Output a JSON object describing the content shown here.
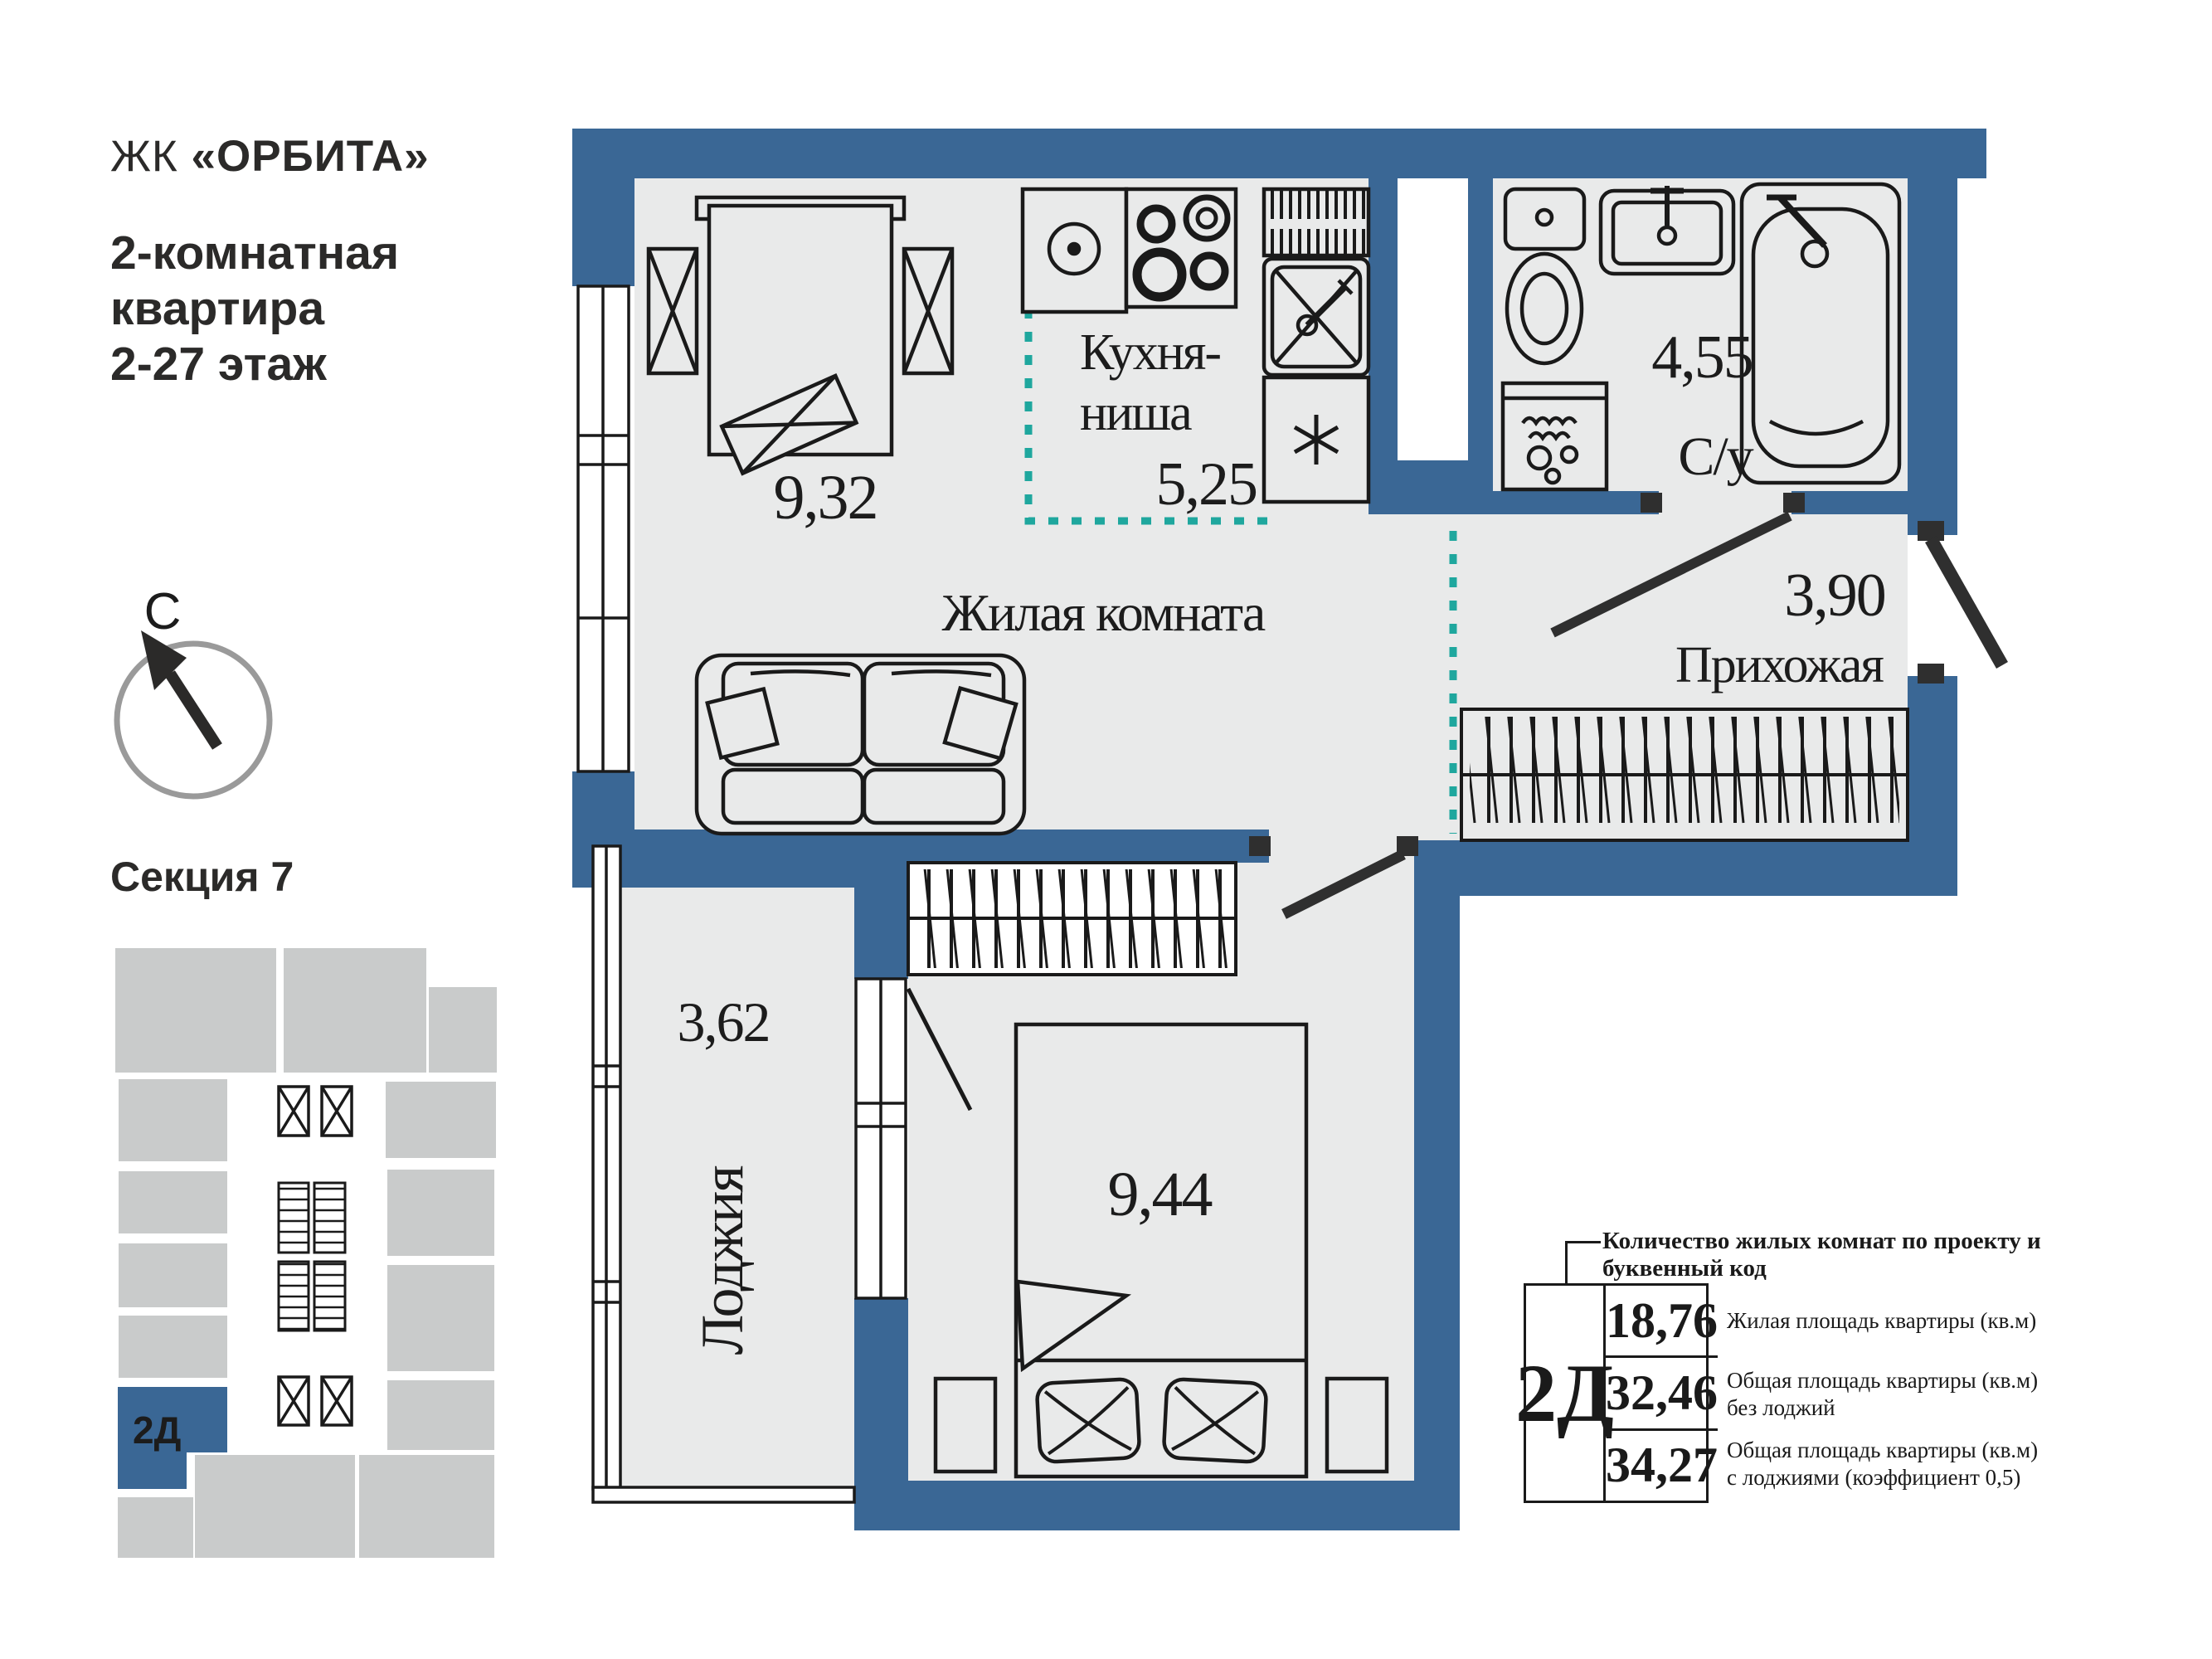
{
  "header": {
    "complex_prefix": "ЖК ",
    "complex_name": "«ОРБИТА»",
    "subtitle_line1": "2-комнатная",
    "subtitle_line2": "квартира",
    "subtitle_line3": "2-27 этаж"
  },
  "compass": {
    "north_label": "С"
  },
  "section": {
    "label": "Секция 7",
    "unit_code": "2Д"
  },
  "plan": {
    "rooms": {
      "living_number": "9,32",
      "kitchen_name_line1": "Кухня-",
      "kitchen_name_line2": "ниша",
      "kitchen_number": "5,25",
      "living_name": "Жилая комната",
      "bath_number": "4,55",
      "bath_name": "С/у",
      "hall_number": "3,90",
      "hall_name": "Прихожая",
      "loggia_number": "3,62",
      "loggia_name": "Лоджия",
      "bedroom_number": "9,44"
    }
  },
  "info": {
    "callout": "Количество жилых комнат по проекту и буквенный код",
    "unit_code": "2Д",
    "rows": [
      {
        "value": "18,76",
        "label_line1": "Жилая площадь квартиры (кв.м)",
        "label_line2": ""
      },
      {
        "value": "32,46",
        "label_line1": "Общая площадь квартиры (кв.м)",
        "label_line2": "без лоджий"
      },
      {
        "value": "34,27",
        "label_line1": "Общая площадь квартиры (кв.м)",
        "label_line2": "с лоджиями (коэффициент 0,5)"
      }
    ]
  },
  "colors": {
    "wall": "#3A6795",
    "floor": "#E9EAEA",
    "teal": "#1FA79E",
    "minimap": "#C9CBCB",
    "door": "#2F2F2F",
    "ink": "#1c1c1c"
  }
}
